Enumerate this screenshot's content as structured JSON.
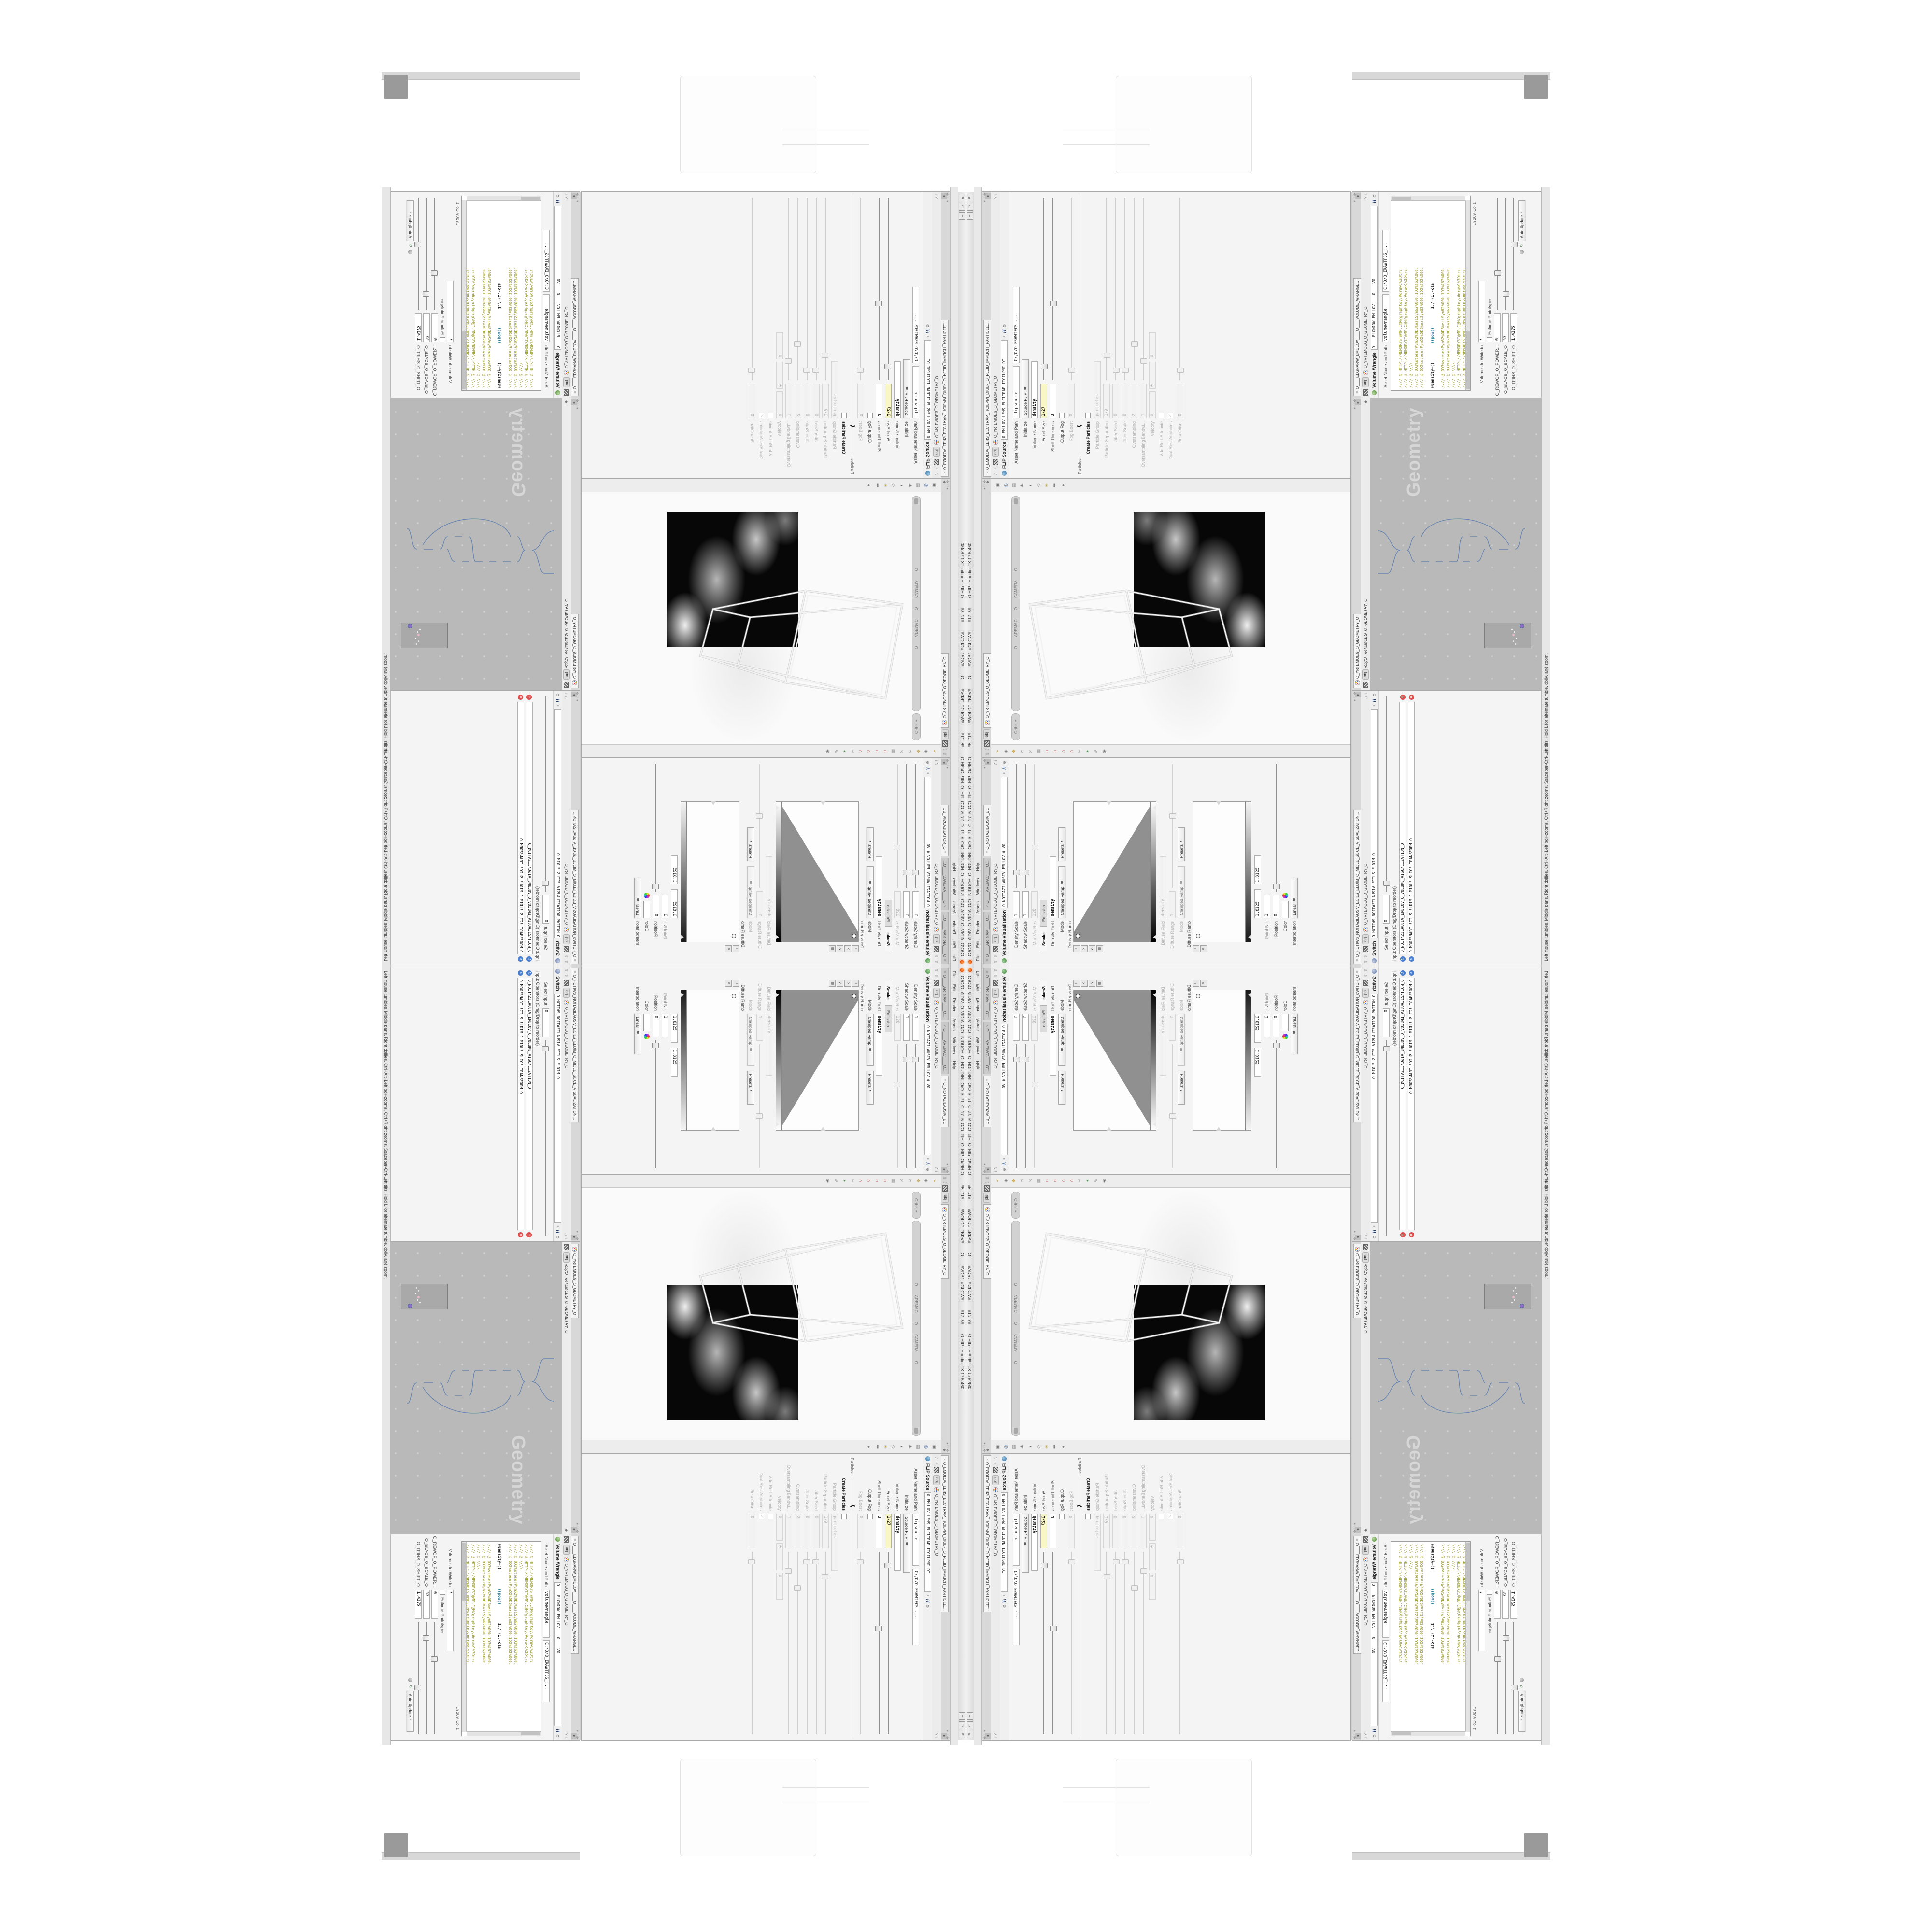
{
  "colors": {
    "yellow_field": "#f8f6c4",
    "network_bg": "#b9b9b9",
    "code_olive": "#99992e",
    "code_teal": "#2e7f9e",
    "node_red_ring": "#6e2323",
    "node_sel_halo": "#ad93dd",
    "node_sel_ring": "#3f5e92",
    "wire": "#5f7fae"
  },
  "window": {
    "title": "C:/O/O_AIDIV_O_VIDIA_O/O_INIDUOH_O_HOUDINI_O/O_5_71_O_17_5_O/O_PIH_O_HIP_O/PIH.O____#5_71#____#WOLG#_#BDV#____O____#VDB#_#GLOW#____#17_5#____O.HIP - Houdini FX 17.5.460",
    "minimize": "–",
    "restore": "▭",
    "close": "✕",
    "menus": [
      "File",
      "Edit",
      "Render",
      "Assets",
      "Windows",
      "Help"
    ]
  },
  "breadcrumb": {
    "root": "obj",
    "node": "O_YRTEMOEG_O_GEOMETRY_O"
  },
  "viewport": {
    "tab": "O_YRTEMOEG_O_GEOMETRY_O",
    "chip": "obj",
    "view_menu": "Ortho",
    "camera_pill": "O____AREMAC____O____CAMERA____O"
  },
  "flip": {
    "tab": "O_EMULOV_LEHS_ELCITRAP_TICILPMI_DIULF_O_FLUID_IMPLICIT_PARTICLE...",
    "title": "FLIP Source",
    "name": "O_EMULOV_LEHS_ELCITRAP_TICILPMI_DI",
    "asset_label": "Asset Name and Path",
    "asset_name": "flipsource",
    "asset_path": "C:/O/O_ERAWTFOS_...",
    "params": [
      {
        "label": "Initialize",
        "value": "Source FLIP"
      },
      {
        "label": "Volume Name",
        "value": "density"
      },
      {
        "label": "Voxel Size",
        "value": "1/27"
      },
      {
        "label": "Shell Thickness",
        "value": "3"
      },
      {
        "label": "Output Fog",
        "value": ""
      },
      {
        "label": "Fog Boost",
        "value": "0"
      },
      {
        "label": "Particles",
        "value": ""
      },
      {
        "label": "Create Particles",
        "value": ""
      },
      {
        "label": "Particle Group",
        "value": "particles"
      },
      {
        "label": "Particle Separation",
        "value": "1/9"
      },
      {
        "label": "Jitter Seed",
        "value": "0"
      },
      {
        "label": "Jitter Scale",
        "value": "0"
      },
      {
        "label": "Oversampling",
        "value": "2"
      },
      {
        "label": "Oversampling Bandwi...",
        "value": "1"
      },
      {
        "label": "Velocity",
        "value": "0",
        "value2": "0",
        "value3": "0"
      },
      {
        "label": "Add Rest Attribute",
        "value": ""
      },
      {
        "label": "Dual Rest Attributes",
        "value": "✓"
      },
      {
        "label": "Rest Offset",
        "value": "0"
      }
    ]
  },
  "volviz": {
    "tabs": [
      "O____ARTNAM____O...",
      "O____AREMAC____O...",
      "O_NOITAZILAUSIV_E..."
    ],
    "title": "Volume Visualization",
    "name": "O_NOITAZILAUSIV_EMULOV_O_VO",
    "params": [
      {
        "label": "Density Scale",
        "value": "1"
      },
      {
        "label": "Shadow Scale",
        "value": "1"
      },
      {
        "label": "Max Vis Res",
        "value": "128"
      }
    ],
    "folder_tabs": [
      "Smoke",
      "Emission"
    ],
    "density_field_label": "Density Field",
    "density_field": "density",
    "mode_label": "Mode",
    "mode": "Clamped Ramp",
    "presets": "Presets",
    "density_ramp_label": "Density Ramp",
    "diffuse_field_label": "Diffuse Field",
    "diffuse_field": "density",
    "diffuse_range_label": "Diffuse Range",
    "diffuse_range": "1",
    "mode2_label": "Mode",
    "mode2": "Clamped Ramp",
    "presets2": "Presets",
    "diffuse_ramp_label": "Diffuse Ramp",
    "range_a": "1.8125",
    "range_b": "1.8125",
    "point_no_label": "Point No.",
    "point_no": "1",
    "position_label": "Position",
    "position": "0",
    "color_label": "Color",
    "interp_label": "Interpolation",
    "interp": "Linear"
  },
  "switch": {
    "tab": "O_HCTIWS_NOITAZILAUSIV_ECILS_ELDIM_O_MIDLE_SLICE_VISUALIZATION...",
    "title": "Switch",
    "name": "O_HCTIWS_NOITAZILAUSIV_ECILS_ELDIM_O",
    "select_input_label": "Select Input",
    "select_input": "0",
    "list_label": "Input Operators (Drag/Drop to reorder)",
    "inputs": [
      "O_NOITAZILAUSIV_EMULOV_O_VOLUME_VISUALIZATION_O",
      "O_MROFSNART_ECILS_ELDIM_O_MIDLE_SLICE_TRANSFORM_O"
    ]
  },
  "network": {
    "tab": "O_YRTEMOEG_O_GEOMETRY_O",
    "chip": "obj",
    "path": "/obj/O_YRTEMOEG_O_GEOMETRY_O",
    "watermark": "Geometry",
    "nodes": [
      {
        "type": "File",
        "name": "O_JBO.VES-PETS-THGILS_O_SLIGHT-STEP-SEV.OBJ_O"
      },
      {
        "type": "CubeSphere",
        "name": "O_EREHPS_EBUC_O_CUBE_SPHERE_O"
      },
      {
        "type": "Wireframe",
        "name": "O_EMARFERIW_NOGYLOP_EREHPS_EBUC_O_CUBE_SPHERE_POLYGON_WIREFRAME_O"
      },
      {
        "type": "Switch",
        "name": "O_HCTIWS_YRTEMOEG_LANRETXE_O_INTERNAL_EXTERNAL_GEOMETRY_SWITCH_O"
      },
      {
        "type": "Clip",
        "name": "O_ECAFRUS_PILC_O_CLIP_SURFACE_O"
      },
      {
        "type": "Clip",
        "name": "O_EMULOV_PILC_O_CLIP_VOLUME_O"
      },
      {
        "type": "FLIP Source",
        "name": "O_EMULOV_LEHS_ELCITRAP_TICILPMI_DIULF_O_FLUID_IMPLICIT_PARTICLE_SHEL_VOLUME_O"
      },
      {
        "type": "VDB from Polygons",
        "name": "O_SNOGILOP_YRTEMOEG_MORF_EMULOV_BDV_O_VDB_VOLUME_FROM_GEOMETRY_POLYGONS_O"
      },
      {
        "type": "Volume Wrangle",
        "name": "O____ELGNARW_EMULOV____O____VOLUME_WRANGLE____O"
      },
      {
        "type": "Volume Visualization",
        "name": "O_NOITAZILAUSIV_EMULOV_O_VOLUME_VISUALIZATION_O"
      },
      {
        "type": "Volume Slice",
        "name": "O_ECILS_ELDIM_O_MIDLE_SLICE_O"
      },
      {
        "type": "Transform",
        "name": "O_MROFSNART_ECILS_ELDIM_O_MIDLE_SLICE_TRANSFORM_O"
      },
      {
        "type": "Switch",
        "name": "O_HCTIWS_NOITAZILAUSIV_ECILS_ELDIM_O_MIDLE_SLICE_VISUALIZATION_SWITCH_O"
      },
      {
        "type": "Merge",
        "name": "O_ECAFRUS_HTIW_EMULOV_EGREM_O_MERGE_VOLUME_WITH_SURFACE_O"
      },
      {
        "type": "Transform",
        "name": "O_MROFSNART_TLUSER_O_RESULT_TRANSFORM_O"
      }
    ]
  },
  "wrangle": {
    "tab": "O____ELGNARW_EMULOV____O____VOLUME_WRANGL...",
    "title": "Volume Wrangle",
    "name": "O____ELGNARW_EMULOV____O____VO",
    "asset_label": "Asset Name and Path",
    "asset_name": "volumewrangle",
    "asset_path": "C:/O/O_ERAWTFOS_...",
    "code_line_url": "//// @ HTTP://MEMORYST@MP.C@M/graphtoy/#draw1%3Dtru",
    "code_line_slashes": "//// @ \\\\\\\\",
    "code_line_data": "//// @ 0D3%steserPym62%0D3%eziSym62%000.1D3%C62%000.",
    "code_expr_a": "@density=((",
    "code_expr_b": "((pow((",
    "code_expr_c": "1./ (1.-cla",
    "cursor_pos": "Ln 209, Col 1",
    "volumes_label": "Volumes to Write to",
    "volumes": "*",
    "enforce_label": "Enforce Prototypes",
    "power_label": "O_REWOP_O_POWER...",
    "power": "6",
    "scale_label": "O_ELACS_O_SCALE_O",
    "scale": "32",
    "shift_label": "O_TFIHS_O_SHIFT_O",
    "shift": "1.4375",
    "auto_update": "Auto Update"
  },
  "statusbar": {
    "text": "Left mouse tumbles. Middle pans. Right dollies. Ctrl+Alt+Left box-zooms. Ctrl+Right zooms. Spacebar-Ctrl-Left tilts. Hold L for alternate tumble, dolly, and zoom."
  }
}
